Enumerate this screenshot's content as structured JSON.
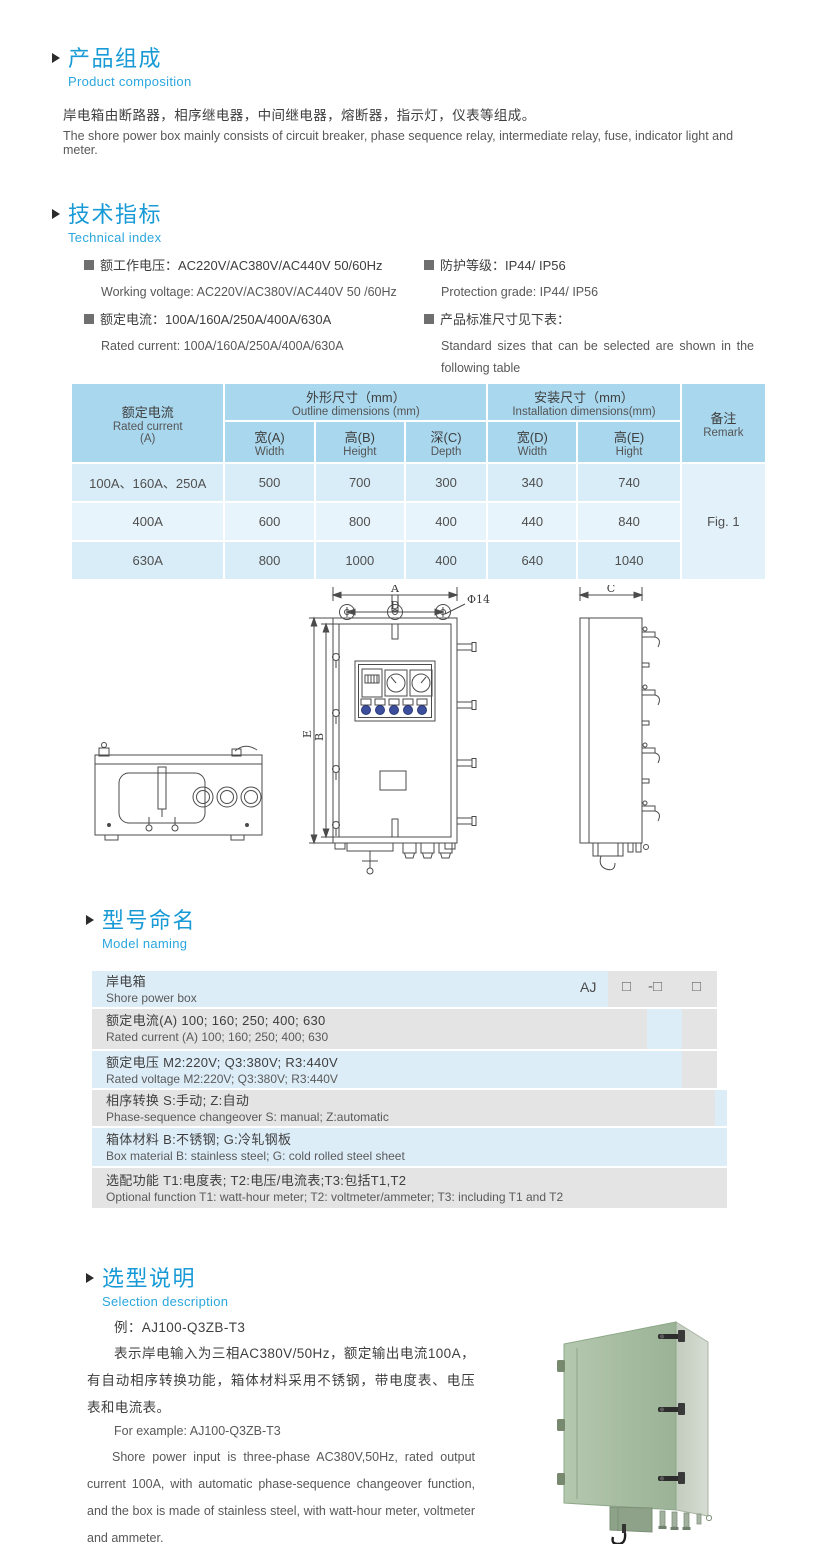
{
  "sections": {
    "composition": {
      "title_cn": "产品组成",
      "title_en": "Product  composition",
      "body_cn": "岸电箱由断路器，相序继电器，中间继电器，熔断器，指示灯，仪表等组成。",
      "body_en": "The shore power box mainly consists of circuit breaker, phase sequence relay, intermediate relay, fuse, indicator light and meter."
    },
    "technical": {
      "title_cn": "技术指标",
      "title_en": "Technical index",
      "items_left": [
        {
          "cn": "额工作电压：AC220V/AC380V/AC440V  50/60Hz",
          "en": "Working voltage: AC220V/AC380V/AC440V 50 /60Hz"
        },
        {
          "cn": "额定电流：100A/160A/250A/400A/630A",
          "en": "Rated current: 100A/160A/250A/400A/630A"
        }
      ],
      "items_right": [
        {
          "cn": "防护等级：IP44/ IP56",
          "en": "Protection grade: IP44/ IP56"
        },
        {
          "cn": "产品标准尺寸见下表：",
          "en": "Standard sizes that can be selected are shown in the following table"
        }
      ]
    },
    "naming": {
      "title_cn": "型号命名",
      "title_en": "Model naming",
      "codes": {
        "prefix": "AJ",
        "c1": "□",
        "c2": "-□",
        "c3": "□"
      },
      "rows": [
        {
          "cn": "岸电箱",
          "en": "Shore power box"
        },
        {
          "cn": "额定电流(A)  100; 160; 250; 400; 630",
          "en": "Rated current (A) 100; 160; 250; 400; 630"
        },
        {
          "cn": "额定电压   M2:220V;  Q3:380V;  R3:440V",
          "en": "Rated voltage   M2:220V;  Q3:380V;  R3:440V"
        },
        {
          "cn": "相序转换  S:手动; Z:自动",
          "en": "Phase-sequence changeover  S: manual;  Z:automatic"
        },
        {
          "cn": "箱体材料    B:不锈钢;  G:冷轧钢板",
          "en": "Box material    B: stainless steel; G: cold rolled steel sheet"
        },
        {
          "cn": "选配功能      T1:电度表;  T2:电压/电流表;T3:包括T1,T2",
          "en": "Optional function   T1: watt-hour meter; T2: voltmeter/ammeter; T3: including T1 and T2"
        }
      ]
    },
    "selection": {
      "title_cn": "选型说明",
      "title_en": "Selection description",
      "example_cn": "例：AJ100-Q3ZB-T3",
      "body_cn": "表示岸电输入为三相AC380V/50Hz，额定输出电流100A，有自动相序转换功能，箱体材料采用不锈钢，带电度表、电压表和电流表。",
      "example_en": "For example: AJ100-Q3ZB-T3",
      "body_en": "Shore power input is three-phase AC380V,50Hz, rated output current 100A, with automatic phase-sequence changeover function, and the box is made of stainless steel, with watt-hour meter, voltmeter and ammeter."
    }
  },
  "dim_table": {
    "header": {
      "current_cn": "额定电流",
      "current_en": "Rated current",
      "current_unit": "(A)",
      "outline_cn": "外形尺寸（mm）",
      "outline_en": "Outline dimensions (mm)",
      "install_cn": "安装尺寸（mm）",
      "install_en": "Installation dimensions(mm)",
      "remark_cn": "备注",
      "remark_en": "Remark",
      "cols": [
        {
          "cn": "宽(A)",
          "en": "Width"
        },
        {
          "cn": "高(B)",
          "en": "Height"
        },
        {
          "cn": "深(C)",
          "en": "Depth"
        },
        {
          "cn": "宽(D)",
          "en": "Width"
        },
        {
          "cn": "高(E)",
          "en": "Hight"
        }
      ]
    },
    "rows": [
      {
        "label": "100A、160A、250A",
        "vals": [
          "500",
          "700",
          "300",
          "340",
          "740"
        ]
      },
      {
        "label": "400A",
        "vals": [
          "600",
          "800",
          "400",
          "440",
          "840"
        ]
      },
      {
        "label": "630A",
        "vals": [
          "800",
          "1000",
          "400",
          "640",
          "1040"
        ]
      }
    ],
    "remark_value": "Fig. 1"
  },
  "drawing": {
    "labels": {
      "a": "A",
      "d": "D",
      "phi": "Φ14",
      "b": "B",
      "e": "E",
      "c": "C"
    }
  },
  "colors": {
    "heading_blue": "#189ad6",
    "subheading_blue": "#2ba6de",
    "table_header_bg": "#a9d7ee",
    "table_row_bg": "#d9edf8",
    "table_row_alt_bg": "#e8f4fb",
    "naming_blue_bg": "#ddedf8",
    "naming_gray_bg": "#e4e4e4",
    "indicator_blue": "#3c4f9c",
    "box_green": "#a9bfa5"
  }
}
